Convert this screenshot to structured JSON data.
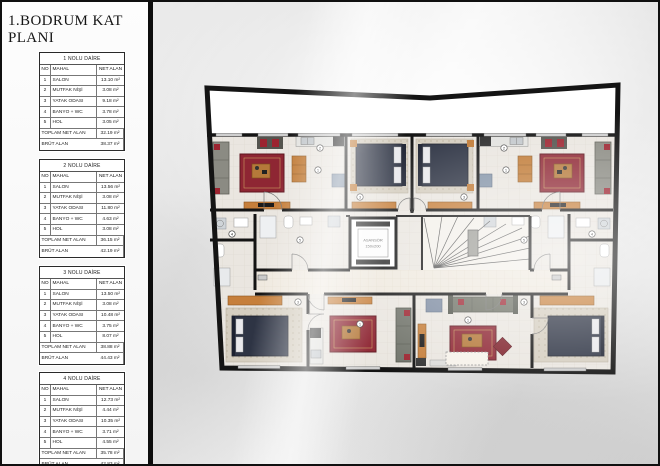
{
  "page": {
    "title": "1.BODRUM KAT PLANI"
  },
  "tables": [
    {
      "title": "1 NOLU DAİRE",
      "col_no": "NO",
      "col_mahal": "MAHAL",
      "col_net": "NET ALAN",
      "rows": [
        {
          "no": "1",
          "mahal": "SALON",
          "net": "13.10 m²"
        },
        {
          "no": "2",
          "mahal": "MUTFAK NİŞİ",
          "net": "3.08 m²"
        },
        {
          "no": "3",
          "mahal": "YATAK ODASI",
          "net": "9.18 m²"
        },
        {
          "no": "4",
          "mahal": "BANYO + WC",
          "net": "3.78 m²"
        },
        {
          "no": "5",
          "mahal": "HOL",
          "net": "3.05 m²"
        }
      ],
      "toplam_label": "TOPLAM NET ALAN",
      "toplam": "32.19 m²",
      "brut_label": "BRÜT ALAN",
      "brut": "38.37 m²"
    },
    {
      "title": "2 NOLU DAİRE",
      "col_no": "NO",
      "col_mahal": "MAHAL",
      "col_net": "NET ALAN",
      "rows": [
        {
          "no": "1",
          "mahal": "SALON",
          "net": "13.56 m²"
        },
        {
          "no": "2",
          "mahal": "MUTFAK NİŞİ",
          "net": "3.08 m²"
        },
        {
          "no": "3",
          "mahal": "YATAK ODASI",
          "net": "11.80 m²"
        },
        {
          "no": "4",
          "mahal": "BANYO + WC",
          "net": "4.63 m²"
        },
        {
          "no": "5",
          "mahal": "HOL",
          "net": "3.08 m²"
        }
      ],
      "toplam_label": "TOPLAM NET ALAN",
      "toplam": "36.15 m²",
      "brut_label": "BRÜT ALAN",
      "brut": "42.19 m²"
    },
    {
      "title": "3 NOLU DAİRE",
      "col_no": "NO",
      "col_mahal": "MAHAL",
      "col_net": "NET ALAN",
      "rows": [
        {
          "no": "1",
          "mahal": "SALON",
          "net": "13.50 m²"
        },
        {
          "no": "2",
          "mahal": "MUTFAK NİŞİ",
          "net": "3.08 m²"
        },
        {
          "no": "3",
          "mahal": "YATAK ODASI",
          "net": "10.48 m²"
        },
        {
          "no": "4",
          "mahal": "BANYO + WC",
          "net": "3.75 m²"
        },
        {
          "no": "5",
          "mahal": "HOL",
          "net": "8.07 m²"
        }
      ],
      "toplam_label": "TOPLAM NET ALAN",
      "toplam": "38.88 m²",
      "brut_label": "BRÜT ALAN",
      "brut": "44.43 m²"
    },
    {
      "title": "4 NOLU DAİRE",
      "col_no": "NO",
      "col_mahal": "MAHAL",
      "col_net": "NET ALAN",
      "rows": [
        {
          "no": "1",
          "mahal": "SALON",
          "net": "12.73 m²"
        },
        {
          "no": "2",
          "mahal": "MUTFAK NİŞİ",
          "net": "4.44 m²"
        },
        {
          "no": "3",
          "mahal": "YATAK ODASI",
          "net": "10.35 m²"
        },
        {
          "no": "4",
          "mahal": "BANYO + WC",
          "net": "3.71 m²"
        },
        {
          "no": "5",
          "mahal": "HOL",
          "net": "4.55 m²"
        }
      ],
      "toplam_label": "TOPLAM NET ALAN",
      "toplam": "35.78 m²",
      "brut_label": "BRÜT ALAN",
      "brut": "42.83 m²"
    }
  ],
  "plan": {
    "elevator_line1": "ASANSÖR",
    "elevator_line2": "150x200",
    "markers": [
      "1",
      "2",
      "3",
      "4",
      "5"
    ],
    "colors": {
      "wall": "#141414",
      "floor": "#eae6e0",
      "corridor": "#efe9df",
      "carpet_red": "#8e2633",
      "carpet_beige": "#d3ccbf",
      "bed": "#2e3444",
      "wood": "#c67f3b",
      "sofa_gray": "#8b8b83",
      "appliance_blue": "#8494a8"
    }
  }
}
